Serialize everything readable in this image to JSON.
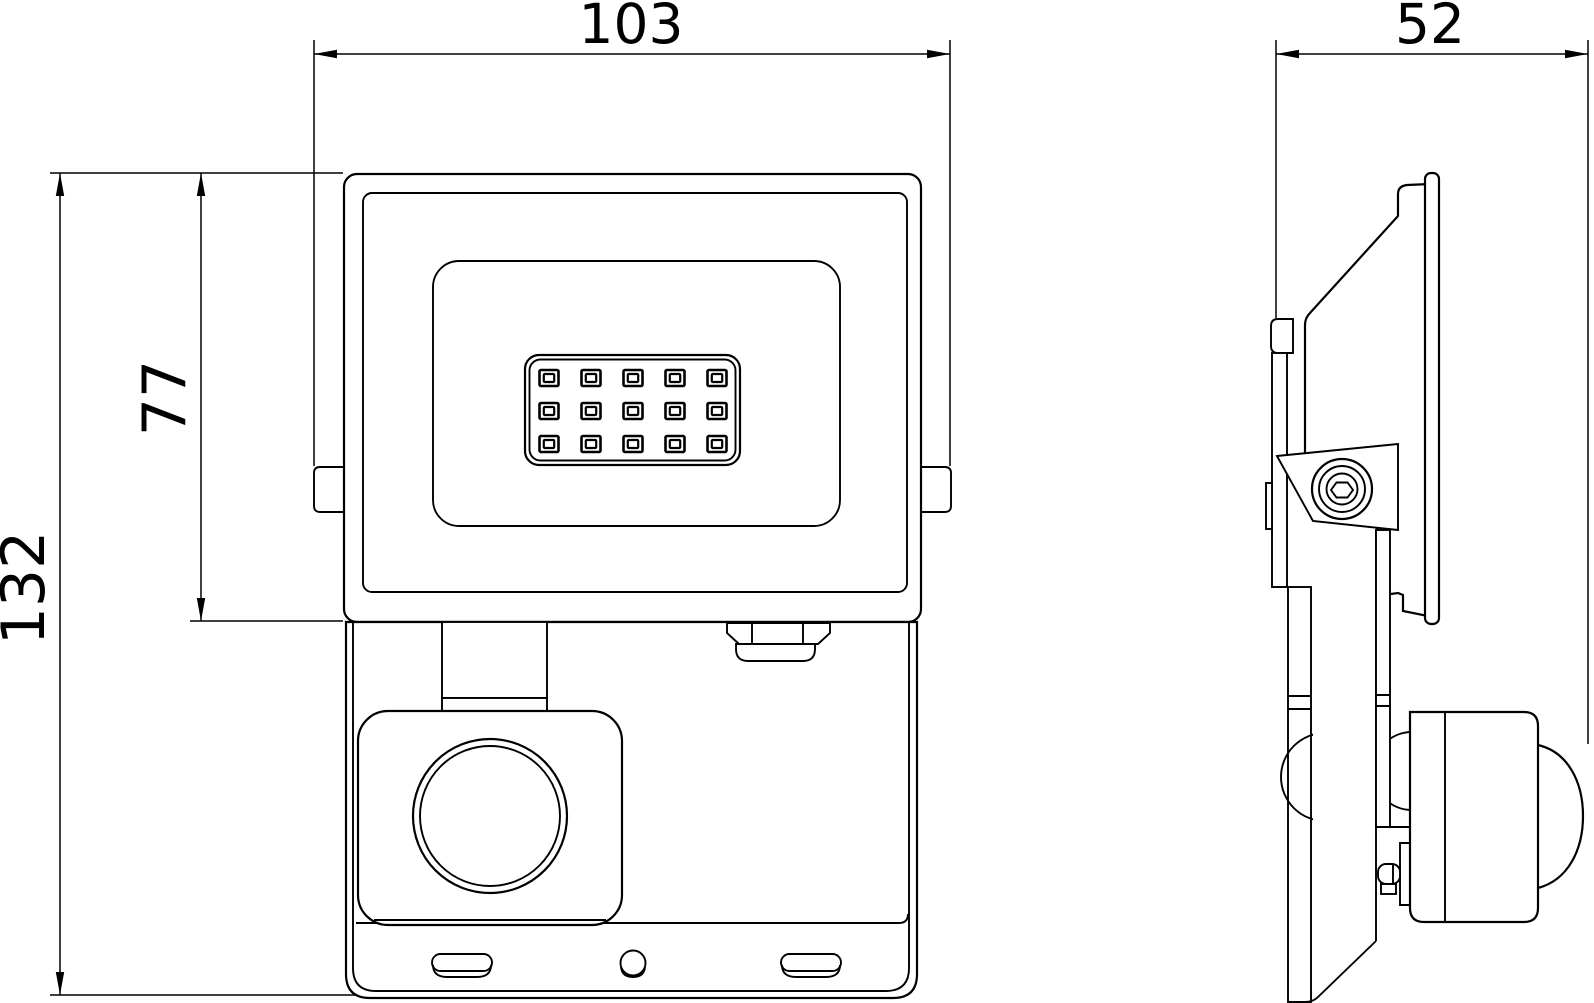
{
  "drawing": {
    "type": "technical-dimension-drawing",
    "subject": "LED floodlight with PIR motion sensor, front and side orthographic views",
    "colors": {
      "line": "#000000",
      "background": "#ffffff"
    },
    "dimensions": {
      "width": {
        "value": "103",
        "orientation": "horizontal",
        "view": "front"
      },
      "depth": {
        "value": "52",
        "orientation": "horizontal",
        "view": "side"
      },
      "height_total": {
        "value": "132",
        "orientation": "vertical",
        "view": "front"
      },
      "height_head": {
        "value": "77",
        "orientation": "vertical",
        "view": "front"
      }
    },
    "led_grid": {
      "cols": 5,
      "rows": 3
    }
  }
}
